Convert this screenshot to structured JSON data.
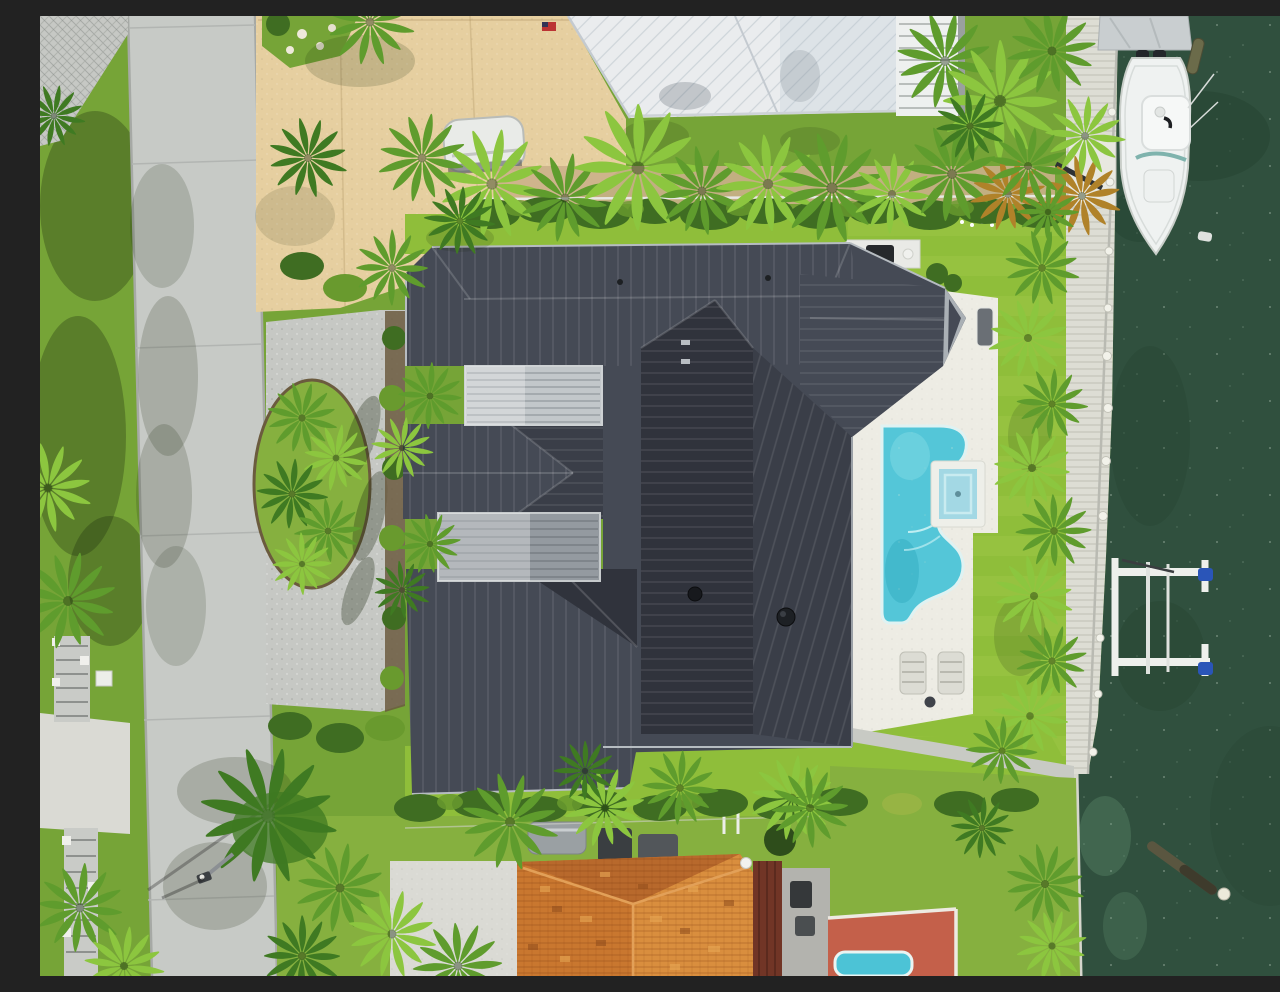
{
  "scene": {
    "description": "Top-down aerial drone photo of a waterfront home with a large charcoal standing-seam metal roof, white paver pool deck with freeform turquoise pool and spa, bright artificial turf lawn, paver circle driveway with palm island, a concrete street on the left, a dark green canal on the right with a private dock, white center-console boat, covered boat, boat lift, and a neighboring orange barrel-tile roof home at the bottom.",
    "view": "orthogonal overhead",
    "time_of_day": "midday sun"
  },
  "palette": {
    "grassBase": "#76a437",
    "grassLight": "#86b03f",
    "turf": "#8fbe3a",
    "turfDark": "#7fae33",
    "road": "#c7cac6",
    "paver": "#c6c8c4",
    "concrete": "#dadad4",
    "tan": "#e6cfa0",
    "whiteRoof": "#eaecee",
    "deckWhite": "#edece4",
    "dock": "#ddddd4",
    "water": "#30503e",
    "waterDark": "#24412f",
    "pool": "#54c6d8",
    "poolDeep": "#2fa9bf",
    "spa": "#a3d8e4",
    "roofLight": "#5a5f6a",
    "roofMid": "#454a55",
    "roofDark": "#3a3e48",
    "roofDarker": "#30333c",
    "pergolaLight": "#c2c7ca",
    "pergolaMid": "#949aa0",
    "fascia": "#aab0b5",
    "orangeTop": "#b8692c",
    "orangeLeft": "#c9772f",
    "orangeRight": "#d98e3e",
    "brownWall": "#713526",
    "redDeck": "#c4604a",
    "hedge": "#3f6d22",
    "hedgeLight": "#699a2e",
    "palmLight": "#8cc63f",
    "palmMid": "#5f9c2d",
    "palmDark": "#3f7a22",
    "palmBrown": "#b08229",
    "boat": "#eff2f1",
    "tarp": "#c9ced0",
    "lift": "#eef0ec",
    "liftBlue": "#2a55b8",
    "log": "#5a5640",
    "mulch": "#6b5a40"
  },
  "objects": [
    {
      "name": "street",
      "label": "Concrete residential street"
    },
    {
      "name": "main-house-roof",
      "label": "Charcoal standing-seam metal hip roof"
    },
    {
      "name": "pergola",
      "label": "Aluminum louvered pergolas (2)"
    },
    {
      "name": "paver-driveway",
      "label": "Paver driveway with palm island"
    },
    {
      "name": "pool",
      "label": "Freeform turquoise pool with raised spa"
    },
    {
      "name": "pool-deck",
      "label": "White paver pool deck"
    },
    {
      "name": "outdoor-kitchen",
      "label": "Outdoor kitchen / grill area"
    },
    {
      "name": "sun-loungers",
      "label": "Two sun loungers"
    },
    {
      "name": "dock",
      "label": "Private dock with mooring posts"
    },
    {
      "name": "boat",
      "label": "White center-console boat"
    },
    {
      "name": "covered-boat",
      "label": "Tarp-covered boat"
    },
    {
      "name": "boat-lift",
      "label": "White boat lift with blue caps"
    },
    {
      "name": "canal-water",
      "label": "Dark green canal water"
    },
    {
      "name": "floating-log",
      "label": "Floating palm log with buoy"
    },
    {
      "name": "white-roof-building",
      "label": "Neighboring white metal roof"
    },
    {
      "name": "orange-tile-roof",
      "label": "Neighboring orange barrel-tile roof"
    },
    {
      "name": "neighbor-pool",
      "label": "Neighbor's small pool on red deck"
    },
    {
      "name": "streetlight",
      "label": "Street light pole"
    },
    {
      "name": "palm-trees",
      "label": "Tropical palms and hedges"
    }
  ],
  "counts": {
    "palm_trees": 48,
    "boats": 2,
    "pools": 2,
    "sun_loungers": 2,
    "boat_lifts": 1
  }
}
